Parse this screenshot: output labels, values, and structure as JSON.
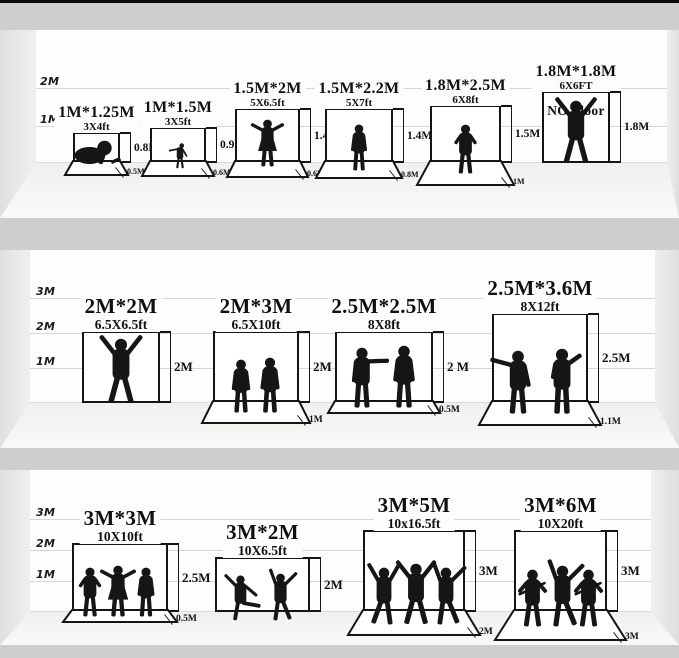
{
  "palette": {
    "ink": "#151515",
    "separator_band": "#cecece",
    "wall": "#fdfdfd",
    "floor": "#f0f0ee",
    "side_wedge": "#e0e0e0"
  },
  "rows": [
    {
      "name": "small-backdrops",
      "axis": [
        {
          "label": "2M",
          "m": 2
        },
        {
          "label": "1M",
          "m": 1
        }
      ],
      "items": [
        {
          "title": "1M*1.25M",
          "subtitle": "3X4ft",
          "height_label": "0.8M",
          "floor_label": "0.5M",
          "figures": "crawling-baby",
          "box": {
            "x": 73,
            "w": 47,
            "h": 31,
            "mat": 14,
            "flare": 9,
            "feet": 3
          }
        },
        {
          "title": "1M*1.5M",
          "subtitle": "3X5ft",
          "height_label": "0.9M",
          "floor_label": "0.6M",
          "figures": "toddler",
          "box": {
            "x": 150,
            "w": 56,
            "h": 36,
            "mat": 15,
            "flare": 9,
            "feet": 5
          }
        },
        {
          "title": "1.5M*2M",
          "subtitle": "5X6.5ft",
          "height_label": "1.4M",
          "floor_label": "0.6M",
          "figures": "woman-arms-up",
          "box": {
            "x": 235,
            "w": 65,
            "h": 55,
            "mat": 16,
            "flare": 9,
            "feet": 3
          }
        },
        {
          "title": "1.5M*2.2M",
          "subtitle": "5X7ft",
          "height_label": "1.4M",
          "floor_label": "0.8M",
          "figures": "man-standing",
          "box": {
            "x": 325,
            "w": 68,
            "h": 55,
            "mat": 17,
            "flare": 10,
            "feet": 7
          }
        },
        {
          "title": "1.8M*2.5M",
          "subtitle": "6X8ft",
          "height_label": "1.5M",
          "floor_label": "1M",
          "figures": "man-hands-on-hips",
          "box": {
            "x": 430,
            "w": 71,
            "h": 58,
            "mat": 24,
            "flare": 14,
            "feet": 10
          }
        },
        {
          "title": "1.8M*1.8M",
          "subtitle": "6X6FT",
          "height_label": "1.8M",
          "no_floor_label": "NO Floor",
          "figures": "man-arms-raised",
          "box": {
            "x": 542,
            "w": 68,
            "h": 72,
            "feet": 0
          }
        }
      ]
    },
    {
      "name": "medium-backdrops",
      "axis": [
        {
          "label": "3M",
          "m": 3
        },
        {
          "label": "2M",
          "m": 2
        },
        {
          "label": "1M",
          "m": 1
        }
      ],
      "items": [
        {
          "title": "2M*2M",
          "subtitle": "6.5X6.5ft",
          "height_label": "2M",
          "figures": "man-arms-up",
          "box": {
            "x": 82,
            "w": 78,
            "h": 72,
            "feet": 0
          }
        },
        {
          "title": "2M*3M",
          "subtitle": "6.5X10ft",
          "height_label": "2M",
          "floor_label": "1M",
          "figures": "two-men-standing",
          "box": {
            "x": 213,
            "w": 86,
            "h": 72,
            "mat": 22,
            "flare": 12,
            "feet": 9
          }
        },
        {
          "title": "2.5M*2.5M",
          "subtitle": "8X8ft",
          "height_label": "2 M",
          "floor_label": "0.5M",
          "figures": "two-men-talking",
          "box": {
            "x": 335,
            "w": 98,
            "h": 72,
            "mat": 12,
            "flare": 8,
            "feet": 4
          }
        },
        {
          "title": "2.5M*3.6M",
          "subtitle": "8X12ft",
          "height_label": "2.5M",
          "floor_label": "1.1M",
          "figures": "two-men-gesturing",
          "box": {
            "x": 492,
            "w": 96,
            "h": 90,
            "mat": 24,
            "flare": 14,
            "feet": 10
          }
        }
      ]
    },
    {
      "name": "large-backdrops",
      "axis": [
        {
          "label": "3M",
          "m": 3
        },
        {
          "label": "2M",
          "m": 2
        },
        {
          "label": "1M",
          "m": 1
        }
      ],
      "items": [
        {
          "title": "3M*3M",
          "subtitle": "10X10ft",
          "height_label": "2.5M",
          "floor_label": "0.5M",
          "figures": "three-adults",
          "box": {
            "x": 72,
            "w": 96,
            "h": 69,
            "mat": 12,
            "flare": 10,
            "feet": 4
          }
        },
        {
          "title": "3M*2M",
          "subtitle": "10X6.5ft",
          "height_label": "2M",
          "figures": "two-dancers",
          "box": {
            "x": 215,
            "w": 95,
            "h": 55,
            "feet": 8
          }
        },
        {
          "title": "3M*5M",
          "subtitle": "10x16.5ft",
          "height_label": "3M",
          "floor_label": "2M",
          "figures": "three-dancers",
          "box": {
            "x": 363,
            "w": 102,
            "h": 82,
            "mat": 25,
            "flare": 16,
            "feet": 12
          }
        },
        {
          "title": "3M*6M",
          "subtitle": "10X20ft",
          "height_label": "3M",
          "floor_label": "3M",
          "figures": "rock-band",
          "box": {
            "x": 514,
            "w": 93,
            "h": 82,
            "mat": 30,
            "flare": 20,
            "feet": 14
          }
        }
      ]
    }
  ]
}
